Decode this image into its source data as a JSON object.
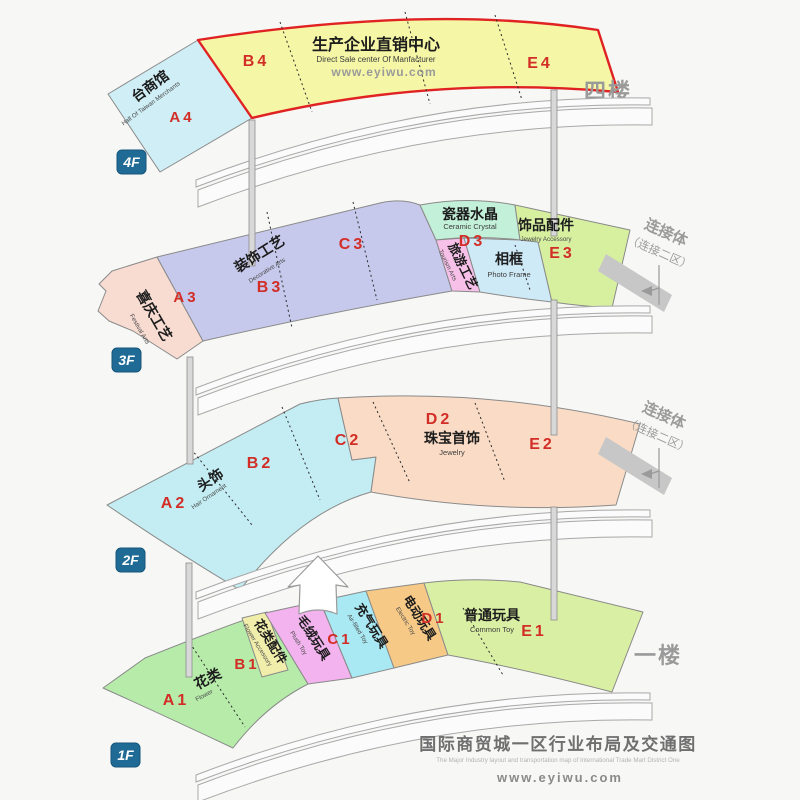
{
  "f4": {
    "badge": "4F",
    "side_label": "四楼",
    "taiwan": {
      "zh": "台商馆",
      "en": "Hall Of Taiwan Merchants",
      "code": "A4"
    },
    "direct": {
      "code_b": "B4",
      "zh": "生产企业直销中心",
      "en": "Direct Sale center Of Manfacturer",
      "url": "www.eyiwu.com",
      "code_e": "E4"
    }
  },
  "f3": {
    "badge": "3F",
    "festival": {
      "zh": "喜庆工艺",
      "en": "Festival Arts",
      "code": "A3"
    },
    "decorative": {
      "zh": "装饰工艺",
      "en": "Decorative Arts",
      "code_b": "B3",
      "code_c": "C3"
    },
    "ceramic": {
      "zh": "瓷器水晶",
      "en": "Ceramic Crystal",
      "code": "D3"
    },
    "tourism": {
      "zh": "旅游工艺",
      "en": "Tourism Arts"
    },
    "photo": {
      "zh": "相框",
      "en": "Photo Frame"
    },
    "accessory": {
      "zh": "饰品配件",
      "en": "Jewelry Accessory",
      "code": "E3"
    },
    "connector": {
      "zh": "连接体",
      "sub": "（连接二区）"
    }
  },
  "f2": {
    "badge": "2F",
    "hair": {
      "code_a": "A2",
      "zh": "头饰",
      "en": "Hair Ornament",
      "code_b": "B2",
      "code_c": "C2"
    },
    "jewelry": {
      "code_d": "D2",
      "zh": "珠宝首饰",
      "en": "Jewelry",
      "code_e": "E2"
    },
    "connector": {
      "zh": "连接体",
      "sub": "（连接二区）"
    }
  },
  "f1": {
    "badge": "1F",
    "side_label": "一楼",
    "flower": {
      "code": "A1",
      "zh": "花类",
      "en": "Flower"
    },
    "flower_acc": {
      "zh": "花类配件",
      "en": "Flower Accessory",
      "code": "B1"
    },
    "plush": {
      "zh": "毛绒玩具",
      "en": "Plush Toy"
    },
    "inflatable": {
      "zh": "充气玩具",
      "en": "Air-filled Toy",
      "code": "C1"
    },
    "electric": {
      "zh": "电动玩具",
      "en": "Electric Toy",
      "code": "D1"
    },
    "common": {
      "zh": "普通玩具",
      "en": "Common Toy",
      "code": "E1"
    }
  },
  "footer": {
    "title_zh": "国际商贸城一区行业布局及交通图",
    "title_en": "The Major Industry layout and transportation map of International Trade Mart District One",
    "url": "www.eyiwu.com"
  },
  "colors": {
    "zone_code": "#d22d26",
    "badge_bg": "#1f6b96",
    "muted_label": "#9a9a9a",
    "highlight_border": "#e02222"
  }
}
